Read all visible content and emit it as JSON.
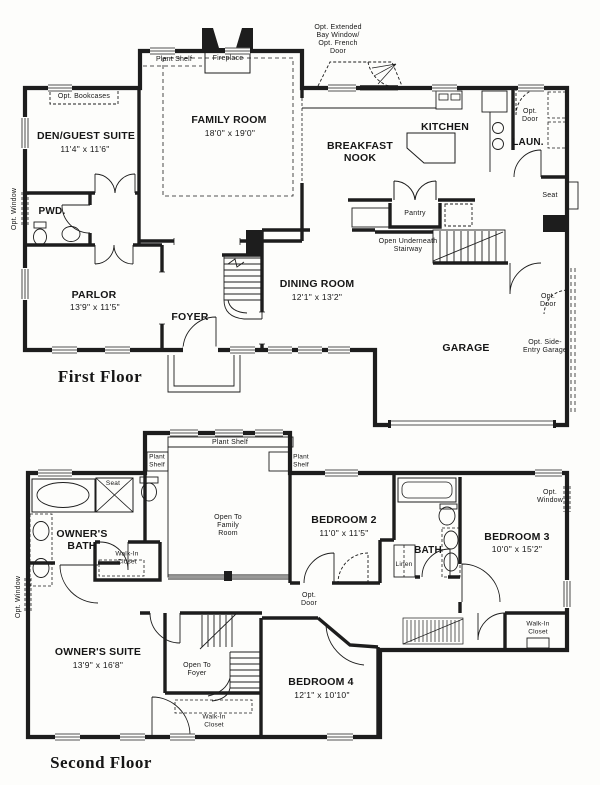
{
  "ink": "#1d1d1d",
  "ff": {
    "caption": "First Floor",
    "den": {
      "name": "DEN/GUEST SUITE",
      "dims": "11'4\" x 11'6\""
    },
    "family": {
      "name": "FAMILY ROOM",
      "dims": "18'0\" x 19'0\""
    },
    "breakfast": {
      "name": "BREAKFAST NOOK"
    },
    "kitchen": {
      "name": "KITCHEN"
    },
    "laundry": {
      "name": "LAUN."
    },
    "powder": {
      "name": "PWD."
    },
    "parlor": {
      "name": "PARLOR",
      "dims": "13'9\" x 11'5\""
    },
    "foyer": {
      "name": "FOYER"
    },
    "dining": {
      "name": "DINING ROOM",
      "dims": "12'1\" x 13'2\""
    },
    "garage": {
      "name": "GARAGE"
    },
    "notes": {
      "bookcases": "Opt. Bookcases",
      "plant_shelf": "Plant Shelf",
      "fireplace": "Fireplace",
      "bay": "Opt. Extended Bay Window/ Opt. French Door",
      "opt_door": "Opt. Door",
      "seat": "Seat",
      "pantry": "Pantry",
      "stairway": "Open Underneath Stairway",
      "side_entry": "Opt. Side-Entry Garage",
      "opt_window": "Opt. Window"
    }
  },
  "sf": {
    "caption": "Second Floor",
    "owners_suite": {
      "name": "OWNER'S SUITE",
      "dims": "13'9\" x 16'8\""
    },
    "owners_bath": {
      "name": "OWNER'S BATH"
    },
    "bed2": {
      "name": "BEDROOM 2",
      "dims": "11'0\" x 11'5\""
    },
    "bed3": {
      "name": "BEDROOM 3",
      "dims": "10'0\" x 15'2\""
    },
    "bed4": {
      "name": "BEDROOM 4",
      "dims": "12'1\" x 10'10\""
    },
    "bath": {
      "name": "BATH"
    },
    "notes": {
      "plant_shelf": "Plant Shelf",
      "seat": "Seat",
      "walk_in": "Walk-In Closet",
      "open_family": "Open To Family Room",
      "open_foyer": "Open To Foyer",
      "linen": "Linen",
      "opt_window": "Opt. Window",
      "opt_door": "Opt. Door"
    }
  }
}
